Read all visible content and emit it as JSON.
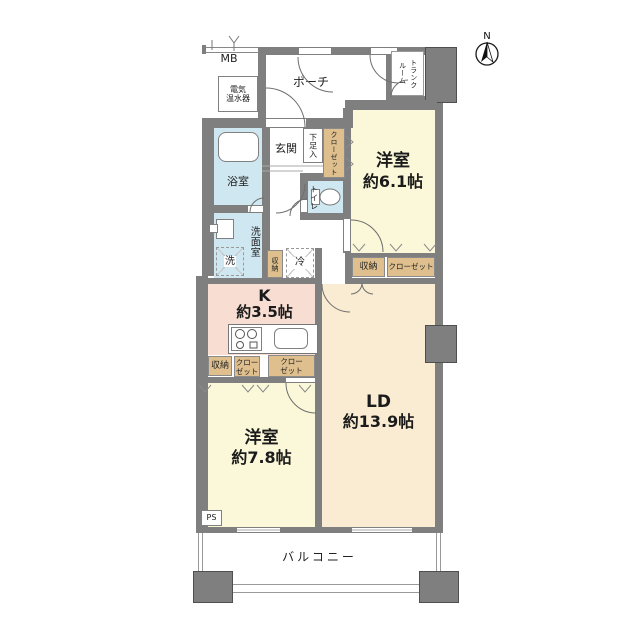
{
  "colors": {
    "wall": "#7f7f7f",
    "yellow": "#fbf8d9",
    "cream": "#faecd2",
    "pink": "#f7ddd2",
    "blue": "#cfe7f0",
    "tan": "#debf8d"
  },
  "compass": {
    "north": "N"
  },
  "outdoor": {
    "porch": "ポーチ",
    "balcony": "バルコニー",
    "trunk_room": "トランク\nルーム",
    "meter_box": "MB",
    "water_heater": "電気\n温水器"
  },
  "rooms": {
    "bedroom1": {
      "name": "洋室",
      "size": "約6.1帖"
    },
    "bedroom2": {
      "name": "洋室",
      "size": "約7.8帖"
    },
    "living_dining": {
      "name": "LD",
      "size": "約13.9帖"
    },
    "kitchen": {
      "name": "K",
      "size": "約3.5帖"
    },
    "entrance": "玄関",
    "bathroom": "浴室",
    "washroom": "洗面室",
    "toilet": "トイレ"
  },
  "storage": {
    "entry_closet": "クローゼット",
    "shoe_cabinet": "下足入",
    "hall_storage": "収納",
    "bedroom1_storage": "収納",
    "bedroom1_closet": "クローゼット",
    "kitchen_storage": "収納",
    "kitchen_closet1": "クロー\nゼット",
    "kitchen_closet2": "クロー\nゼット"
  },
  "fixtures": {
    "washer": "洗",
    "refrigerator": "冷",
    "pipe_space": "PS"
  }
}
